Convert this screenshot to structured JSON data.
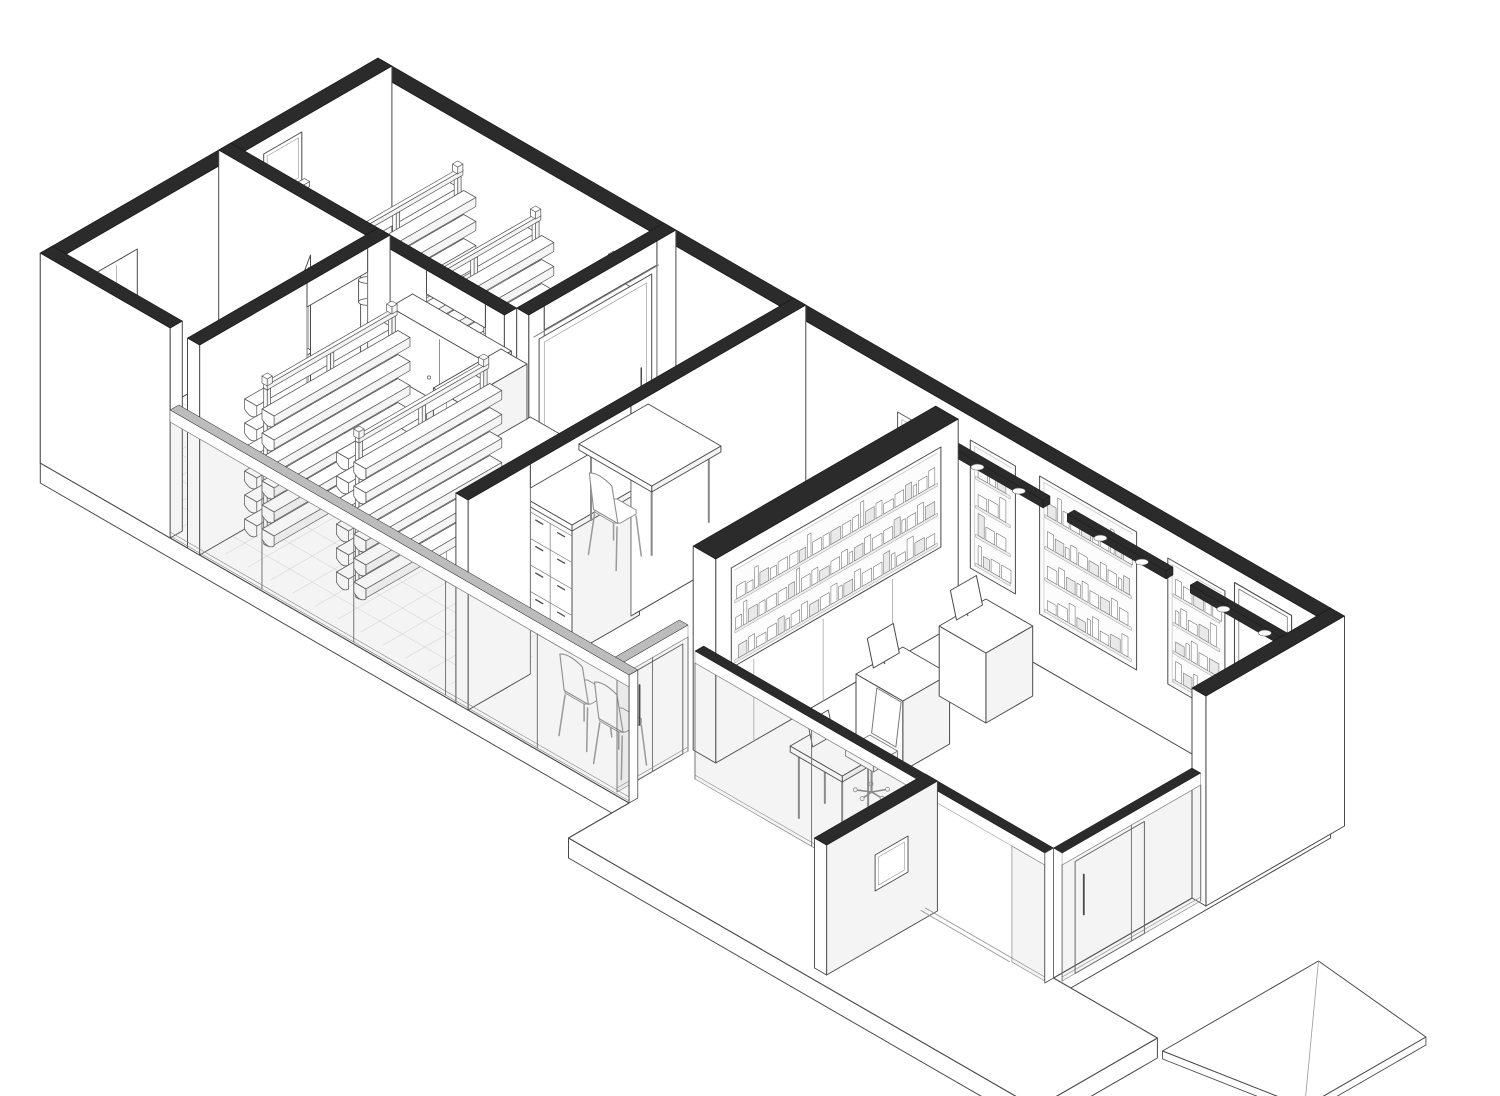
{
  "canvas": {
    "w": 1500,
    "h": 1096,
    "background": "#ffffff"
  },
  "projection": {
    "x0": 378,
    "y0": 268,
    "ux": 0.866,
    "uy": 0.5
  },
  "palette": {
    "ink": "#4a4a4a",
    "ink_soft": "#8f8f8f",
    "ink_faint": "#c9c9c9",
    "wall_black": "#2b2b2b",
    "glass_band": "#bcbcbc",
    "glass_tint": "rgba(150,150,150,0.10)",
    "white": "#ffffff",
    "shade": "#f4f4f4",
    "tile": "#dcdcdc",
    "product_alt": "#e9e9e9"
  },
  "building": {
    "length": 1100,
    "width": 390,
    "cut_height": 210,
    "glass_height": 130,
    "wall_thickness": 16,
    "slab_depth": 20
  },
  "scene": [
    {
      "t": "slab",
      "name": "floor-slab",
      "depth": 20,
      "pts": [
        [
          0,
          0
        ],
        [
          1100,
          0
        ],
        [
          1100,
          320
        ],
        [
          1220,
          320
        ],
        [
          1220,
          460
        ],
        [
          680,
          460
        ],
        [
          680,
          390
        ],
        [
          0,
          390
        ]
      ],
      "edges": [
        [
          [
            0,
            390
          ],
          [
            680,
            390
          ]
        ],
        [
          [
            680,
            390
          ],
          [
            680,
            460
          ]
        ],
        [
          [
            680,
            460
          ],
          [
            1220,
            460
          ]
        ],
        [
          [
            1220,
            460
          ],
          [
            1220,
            320
          ]
        ],
        [
          [
            1100,
            320
          ],
          [
            1100,
            0
          ]
        ]
      ]
    },
    {
      "t": "ramp",
      "name": "entry-ramp",
      "a": [
        1236,
        150
      ],
      "b": [
        1236,
        330
      ],
      "c": [
        1360,
        290
      ],
      "e": [
        1360,
        150
      ],
      "drop": 14
    },
    {
      "t": "grid",
      "name": "tile-floor-storage",
      "u0": 16,
      "v0": 16,
      "u1": 330,
      "v1": 170,
      "step": 26
    },
    {
      "t": "grid",
      "name": "tile-floor-corridor",
      "u0": 16,
      "v0": 170,
      "u1": 478,
      "v1": 374,
      "step": 26
    },
    {
      "t": "wallU",
      "name": "back-wall",
      "u0": 0,
      "u1": 1100,
      "v": 0,
      "th": 16,
      "h": 210,
      "band": "black"
    },
    {
      "t": "wallV",
      "name": "west-end-wall",
      "u": 0,
      "v0": 0,
      "v1": 390,
      "th": 16,
      "h": 210,
      "band": "black"
    },
    {
      "t": "window",
      "name": "west-window",
      "v0": 104,
      "v1": 148,
      "z0": 148,
      "z1": 196
    },
    {
      "t": "poster",
      "name": "wall-poster",
      "u0": 616,
      "u1": 656,
      "z0": 92,
      "z1": 172
    },
    {
      "t": "nicheU",
      "name": "display-niche-1",
      "u0": 700,
      "u1": 752,
      "z0": 58,
      "z1": 186,
      "rows": 4,
      "seed": 3
    },
    {
      "t": "nicheU",
      "name": "display-niche-2",
      "u0": 780,
      "u1": 892,
      "z0": 52,
      "z1": 190,
      "rows": 4,
      "seed": 5
    },
    {
      "t": "nicheU",
      "name": "display-niche-3",
      "u0": 928,
      "u1": 994,
      "z0": 56,
      "z1": 182,
      "rows": 4,
      "seed": 7
    },
    {
      "t": "backdoor",
      "name": "back-room-door",
      "u0": 1010,
      "u1": 1066,
      "z1": 192
    },
    {
      "t": "lightbar",
      "name": "light-track-1",
      "u0": 700,
      "u1": 814,
      "v": 42,
      "z": 190
    },
    {
      "t": "lightbar",
      "name": "light-track-2",
      "u0": 842,
      "u1": 956,
      "v": 42,
      "z": 190
    },
    {
      "t": "lightbar",
      "name": "light-track-3",
      "u0": 984,
      "u1": 1098,
      "v": 42,
      "z": 190
    },
    {
      "t": "rack",
      "name": "storage-rack-1",
      "u": 110,
      "v0": 14,
      "v1": 164,
      "h": 156
    },
    {
      "t": "rack",
      "name": "storage-rack-2",
      "u": 200,
      "v0": 14,
      "v1": 164,
      "h": 156
    },
    {
      "t": "rack",
      "name": "storage-rack-3",
      "u": 290,
      "v0": 14,
      "v1": 164,
      "h": 156
    },
    {
      "t": "wallV",
      "name": "meeting-room-partition",
      "u": 330,
      "v0": 0,
      "v1": 170,
      "th": 14,
      "h": 210,
      "band": "black",
      "open": [
        [
          22,
          152
        ]
      ]
    },
    {
      "t": "slidedoor",
      "name": "sliding-door",
      "u": 352,
      "v0": 36,
      "v1": 166,
      "h": 188
    },
    {
      "t": "wallU",
      "name": "storage-partition",
      "u0": 0,
      "u1": 330,
      "v": 170,
      "th": 14,
      "h": 210,
      "band": "black",
      "open": [
        [
          240,
          308
        ]
      ]
    },
    {
      "t": "wallcab",
      "name": "wall-cabinet",
      "u0": 210,
      "u1": 324,
      "v": 170,
      "d": 26,
      "z0": 96,
      "z1": 164
    },
    {
      "t": "pipe",
      "name": "duct-pipe",
      "u": 174,
      "v": 186,
      "r": 7,
      "h": 206,
      "sz": 146
    },
    {
      "t": "sink",
      "name": "washbasin",
      "u0": 16,
      "u1": 58,
      "v0": 306,
      "v1": 358,
      "z": 74
    },
    {
      "t": "mirrorcab",
      "name": "mirror-cabinet",
      "v0": 294,
      "v1": 342,
      "z0": 116,
      "z1": 174
    },
    {
      "t": "doorleaf",
      "name": "wc-door",
      "hu": 170,
      "hv": 268,
      "fu": 134,
      "fv": 212,
      "h": 186
    },
    {
      "t": "wallV",
      "name": "wc-wall",
      "u": 170,
      "v0": 170,
      "v1": 390,
      "th": 14,
      "h": 210,
      "band": "black",
      "open": [
        [
          196,
          266
        ]
      ]
    },
    {
      "t": "tallcab",
      "name": "storage-cabinet",
      "u0": 338,
      "u1": 368,
      "v0": 196,
      "v1": 274,
      "h": 186
    },
    {
      "t": "drawercab",
      "name": "apothecary-drawer-cabinet",
      "u0": 372,
      "u1": 498,
      "v0": 196,
      "v1": 274,
      "h": 126,
      "cols": 5,
      "rows": 4
    },
    {
      "t": "rack",
      "name": "storage-rack-4",
      "u": 212,
      "v0": 192,
      "v1": 342,
      "h": 156
    },
    {
      "t": "rack",
      "name": "storage-rack-5",
      "u": 318,
      "v0": 192,
      "v1": 342,
      "h": 156
    },
    {
      "t": "wallV",
      "name": "office-partition",
      "u": 480,
      "v0": 0,
      "v1": 390,
      "th": 14,
      "h": 210,
      "band": "black",
      "open": [
        [
          202,
          318
        ]
      ]
    },
    {
      "t": "table",
      "name": "meeting-table",
      "u0": 368,
      "u1": 452,
      "v0": 56,
      "v1": 136,
      "h": 76
    },
    {
      "t": "chairm",
      "name": "meeting-chair",
      "u": 424,
      "v": 150
    },
    {
      "t": "chairm",
      "name": "waiting-chair-1",
      "u": 588,
      "v": 348
    },
    {
      "t": "chairm",
      "name": "waiting-chair-2",
      "u": 636,
      "v": 356
    },
    {
      "t": "glassV",
      "name": "corridor-glass-door",
      "u": 654,
      "v0": 306,
      "v1": 388,
      "h": 128,
      "panes": 2,
      "door": [
        312,
        372
      ],
      "band": "glass"
    },
    {
      "t": "wallV",
      "name": "otc-display-wall",
      "u": 664,
      "v0": 20,
      "v1": 300,
      "th": 26,
      "h": 204,
      "band": "black"
    },
    {
      "t": "nicheV",
      "name": "otc-product-shelves",
      "uf": 690,
      "v0": 40,
      "v1": 282,
      "z0": 86,
      "z1": 186,
      "rows": 3,
      "seed": 11
    },
    {
      "t": "seams",
      "name": "display-wall-panels",
      "uf": 690,
      "vs": [
        96,
        176,
        256
      ],
      "z": 82
    },
    {
      "t": "counter",
      "name": "checkout-counter-1",
      "u0": 752,
      "u1": 806,
      "v0": 146,
      "v1": 200,
      "h": 70
    },
    {
      "t": "counter",
      "name": "checkout-counter-2",
      "u0": 752,
      "u1": 806,
      "v0": 50,
      "v1": 104,
      "h": 70
    },
    {
      "t": "desk",
      "name": "service-desk",
      "u0": 788,
      "u1": 848,
      "v0": 272,
      "v1": 312,
      "h": 72
    },
    {
      "t": "ochair",
      "name": "desk-chair",
      "u": 814,
      "v": 244
    },
    {
      "t": "wallU",
      "name": "facade-solid",
      "u0": 0,
      "u1": 150,
      "v": 376,
      "th": 14,
      "h": 210,
      "band": "black"
    },
    {
      "t": "glassU",
      "name": "facade-glazing",
      "u0": 150,
      "u1": 680,
      "v": 380,
      "h": 128,
      "panes": 5,
      "band": "glass"
    },
    {
      "t": "glassU",
      "name": "storefront-glazing",
      "u0": 696,
      "u1": 1100,
      "v": 320,
      "h": 130,
      "panes": 3,
      "band": "black",
      "open": [
        952,
        1062
      ]
    },
    {
      "t": "wingwall",
      "name": "entry-wing-wall",
      "u": 952,
      "v0": 320,
      "v1": 448,
      "th": 14,
      "h": 130
    },
    {
      "t": "threshold",
      "name": "entry-threshold",
      "u0": 956,
      "u1": 1058,
      "v": 324
    },
    {
      "t": "wallV",
      "name": "east-end-wall",
      "u": 1100,
      "v0": 0,
      "v1": 160,
      "th": 16,
      "h": 210,
      "band": "black"
    },
    {
      "t": "glassV",
      "name": "entrance-glazing",
      "u": 1100,
      "v0": 160,
      "v1": 320,
      "h": 130,
      "panes": 2,
      "door": [
        225,
        305
      ],
      "band": "black"
    }
  ]
}
